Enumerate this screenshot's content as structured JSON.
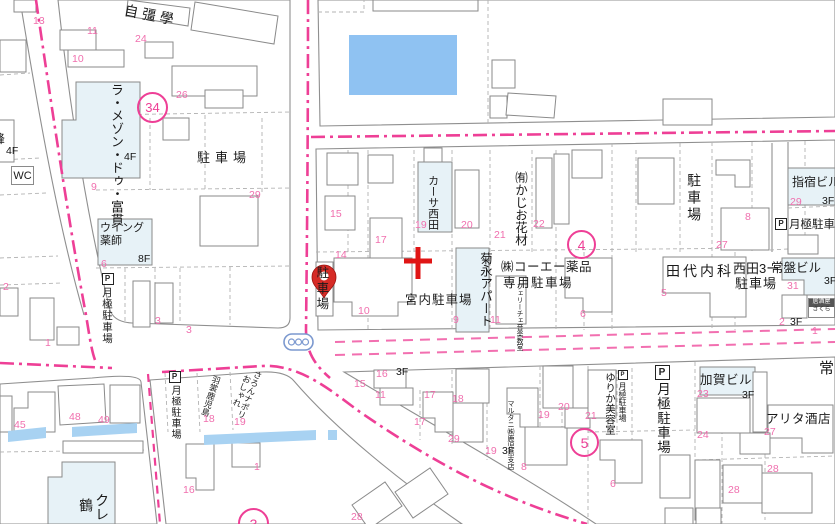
{
  "colors": {
    "boundary_pink": "#ee3f96",
    "lot_number_pink": "#f06fae",
    "water_blue": "#8fc2f2",
    "stream_blue": "#a8d2f2",
    "notable_building_fill": "#e7f2f7",
    "pin_red": "#d62b26",
    "cross_red": "#e01515",
    "outline_gray": "#8a8a8a"
  },
  "icons": {
    "parking_p": "P"
  },
  "labels": {
    "jikyo_gakusha": "自彊學",
    "la_maison": "ラ・メゾン・ドゥ・富貫",
    "parking_nw": "駐車場",
    "wc": "WC",
    "edge_partial": "峰",
    "wing_pharmacy": "ウイング薬師",
    "tsukigime_w": "月極駐車場",
    "casa_nishida": "カーサ西田",
    "kajio_kazai": "㈲かじお花材",
    "kikunaga_apart": "菊永アパート",
    "koei_line1": "㈱コーエー薬品",
    "koei_line2": "専用駐車場",
    "felice": "フェリーチェ音楽教室",
    "miyauchi_parking": "宮内駐車場",
    "pin_parking": "駐車場",
    "parking_e": "駐車場",
    "tashiro_naika": "田代内科",
    "ibusuki_bldg": "指宿ビル",
    "tsukigime_ne": "月極駐車場",
    "nishida3_line1": "西田3ー",
    "nishida3_line2": "駐車場",
    "tokiwa_bldg": "常盤ビル",
    "izakaya_line1": "居酒屋",
    "izakaya_line2": "さくら",
    "tokiwa_street": "常",
    "tsukigime_sw": "月極駐車場",
    "hagoromo": "羽裳鹿児島",
    "oshare_line1": "おしゃれ",
    "oshare_line2": "さろんナポリ",
    "kure_col1": "クレ",
    "kure_col2": "鶴",
    "yurika_salon": "ゆりか美容室",
    "tsukigime_s_small": "月極駐車場",
    "tsukigime_s_big": "月極駐車場",
    "kaga_bldg": "加賀ビル",
    "arita_saketen": "アリタ酒店",
    "marutani": "マルタニ㈱鹿児島支店"
  },
  "circled": {
    "nw": "34",
    "center": "4",
    "south": "5",
    "bottom": "3"
  },
  "floor_labels": [
    {
      "t": "4F",
      "x": 124,
      "y": 152
    },
    {
      "t": "4F",
      "x": 6,
      "y": 146
    },
    {
      "t": "8F",
      "x": 138,
      "y": 254
    },
    {
      "t": "3F",
      "x": 822,
      "y": 196
    },
    {
      "t": "3F",
      "x": 824,
      "y": 276
    },
    {
      "t": "3F",
      "x": 396,
      "y": 367
    },
    {
      "t": "3F",
      "x": 502,
      "y": 446
    },
    {
      "t": "3F",
      "x": 742,
      "y": 390
    },
    {
      "t": "3F",
      "x": 790,
      "y": 317
    }
  ],
  "lot_numbers": [
    {
      "t": "13",
      "x": 33,
      "y": 16
    },
    {
      "t": "11",
      "x": 87,
      "y": 26
    },
    {
      "t": "10",
      "x": 72,
      "y": 54
    },
    {
      "t": "24",
      "x": 135,
      "y": 34
    },
    {
      "t": "26",
      "x": 176,
      "y": 90
    },
    {
      "t": "9",
      "x": 91,
      "y": 182
    },
    {
      "t": "29",
      "x": 249,
      "y": 190
    },
    {
      "t": "6",
      "x": 101,
      "y": 259
    },
    {
      "t": "2",
      "x": 3,
      "y": 282
    },
    {
      "t": "3",
      "x": 155,
      "y": 316
    },
    {
      "t": "3",
      "x": 186,
      "y": 325
    },
    {
      "t": "1",
      "x": 45,
      "y": 338
    },
    {
      "t": "15",
      "x": 330,
      "y": 209
    },
    {
      "t": "17",
      "x": 375,
      "y": 235
    },
    {
      "t": "14",
      "x": 335,
      "y": 250
    },
    {
      "t": "10",
      "x": 358,
      "y": 306
    },
    {
      "t": "19",
      "x": 415,
      "y": 220
    },
    {
      "t": "20",
      "x": 461,
      "y": 220
    },
    {
      "t": "21",
      "x": 494,
      "y": 230
    },
    {
      "t": "22",
      "x": 533,
      "y": 219
    },
    {
      "t": "9",
      "x": 453,
      "y": 315
    },
    {
      "t": "11",
      "x": 490,
      "y": 315
    },
    {
      "t": "6",
      "x": 580,
      "y": 309
    },
    {
      "t": "5",
      "x": 661,
      "y": 288
    },
    {
      "t": "27",
      "x": 716,
      "y": 240
    },
    {
      "t": "8",
      "x": 745,
      "y": 212
    },
    {
      "t": "29",
      "x": 790,
      "y": 197
    },
    {
      "t": "31",
      "x": 787,
      "y": 281
    },
    {
      "t": "2",
      "x": 779,
      "y": 317
    },
    {
      "t": "1",
      "x": 812,
      "y": 326
    },
    {
      "t": "23",
      "x": 697,
      "y": 389
    },
    {
      "t": "24",
      "x": 697,
      "y": 430
    },
    {
      "t": "27",
      "x": 764,
      "y": 427
    },
    {
      "t": "28",
      "x": 767,
      "y": 464
    },
    {
      "t": "28",
      "x": 728,
      "y": 485
    },
    {
      "t": "6",
      "x": 610,
      "y": 479
    },
    {
      "t": "21",
      "x": 585,
      "y": 411
    },
    {
      "t": "45",
      "x": 14,
      "y": 420
    },
    {
      "t": "48",
      "x": 69,
      "y": 412
    },
    {
      "t": "49",
      "x": 98,
      "y": 415
    },
    {
      "t": "18",
      "x": 203,
      "y": 414
    },
    {
      "t": "19",
      "x": 234,
      "y": 417
    },
    {
      "t": "16",
      "x": 183,
      "y": 485
    },
    {
      "t": "1",
      "x": 254,
      "y": 462
    },
    {
      "t": "16",
      "x": 376,
      "y": 369
    },
    {
      "t": "15",
      "x": 354,
      "y": 379
    },
    {
      "t": "11",
      "x": 375,
      "y": 390
    },
    {
      "t": "17",
      "x": 424,
      "y": 390
    },
    {
      "t": "18",
      "x": 452,
      "y": 394
    },
    {
      "t": "17",
      "x": 414,
      "y": 417
    },
    {
      "t": "29",
      "x": 448,
      "y": 434
    },
    {
      "t": "19",
      "x": 485,
      "y": 446
    },
    {
      "t": "19",
      "x": 538,
      "y": 410
    },
    {
      "t": "20",
      "x": 558,
      "y": 402
    },
    {
      "t": "8",
      "x": 521,
      "y": 462
    },
    {
      "t": "28",
      "x": 351,
      "y": 512
    }
  ]
}
